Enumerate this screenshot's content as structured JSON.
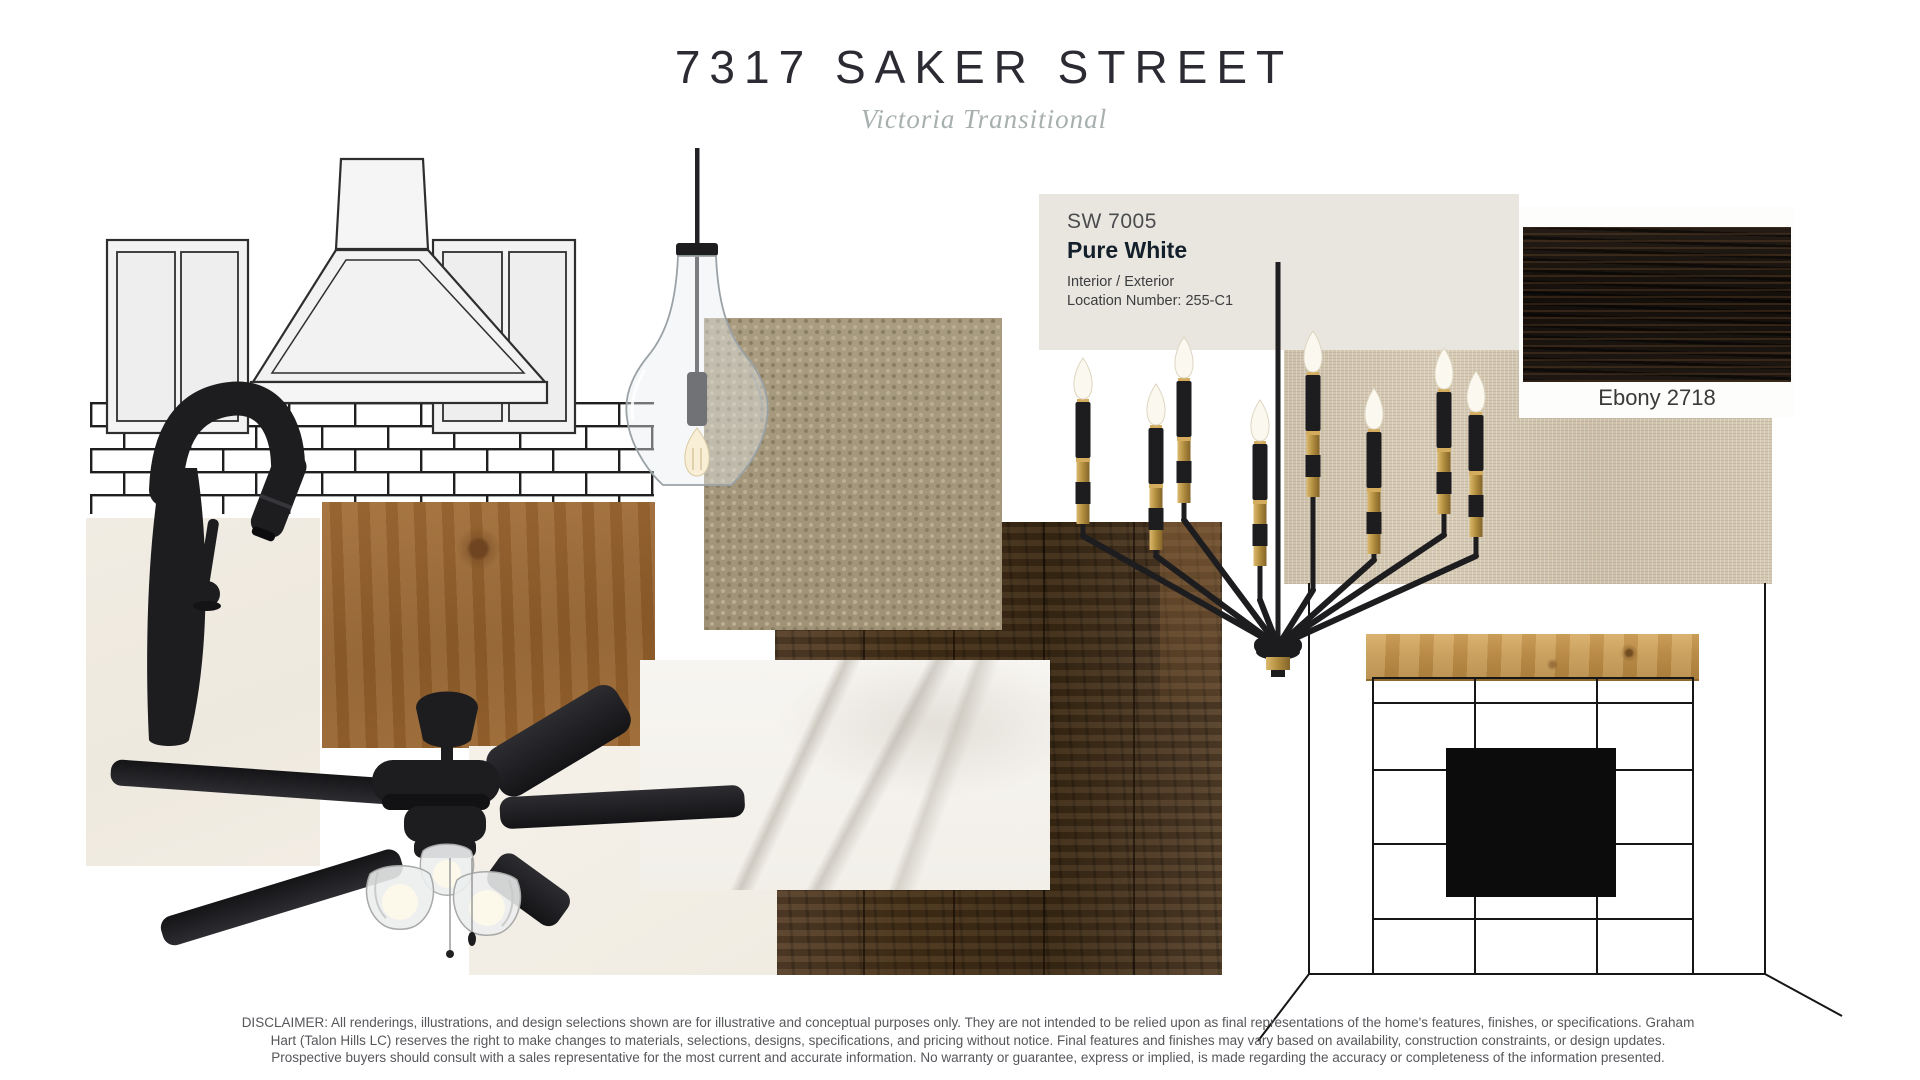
{
  "board": {
    "title": "7317 SAKER STREET",
    "subtitle": "Victoria Transitional"
  },
  "paint_swatch": {
    "code": "SW 7005",
    "name": "Pure White",
    "usage": "Interior / Exterior",
    "location_number": "Location Number: 255-C1",
    "swatch_color": "#e9e6e0"
  },
  "stain_swatch": {
    "label": "Ebony 2718",
    "swatch_color": "#1d1712"
  },
  "sample_colors": {
    "counter_quartz": "#f0ebe2",
    "alder_wood": "#9c6833",
    "carpet": "#a3967b",
    "linen": "#d4c7b1",
    "wood_flooring": "#46331f",
    "marble": "#f5f3ef",
    "quartz_slab": "#f2eee5",
    "mantel_wood": "#c2934c",
    "fixture_black": "#1d1d20",
    "fixture_brass": "#b5913f"
  },
  "fixtures": {
    "faucet": "matte-black-pulldown-faucet",
    "pendant": "clear-glass-pendant-light",
    "chandelier": "black-brass-candle-chandelier",
    "ceiling_fan": "matte-black-ceiling-fan",
    "kitchen_elevation": "cabinet-hood-subway-tile-drawing",
    "fireplace_elevation": "fireplace-tile-surround-drawing"
  },
  "disclaimer": {
    "line1": "DISCLAIMER: All renderings, illustrations, and design selections shown are for illustrative and conceptual purposes only. They are not intended to be relied upon as final representations of the home's features, finishes, or specifications. Graham",
    "line2": "Hart (Talon Hills LC) reserves the right to make changes to materials, selections, designs, specifications, and pricing without notice. Final features and finishes may vary based on availability, construction constraints, or design updates.",
    "line3": "Prospective buyers should consult with a sales representative for the most current and accurate information. No warranty or guarantee, express or implied, is made regarding the accuracy or completeness of the information presented."
  }
}
